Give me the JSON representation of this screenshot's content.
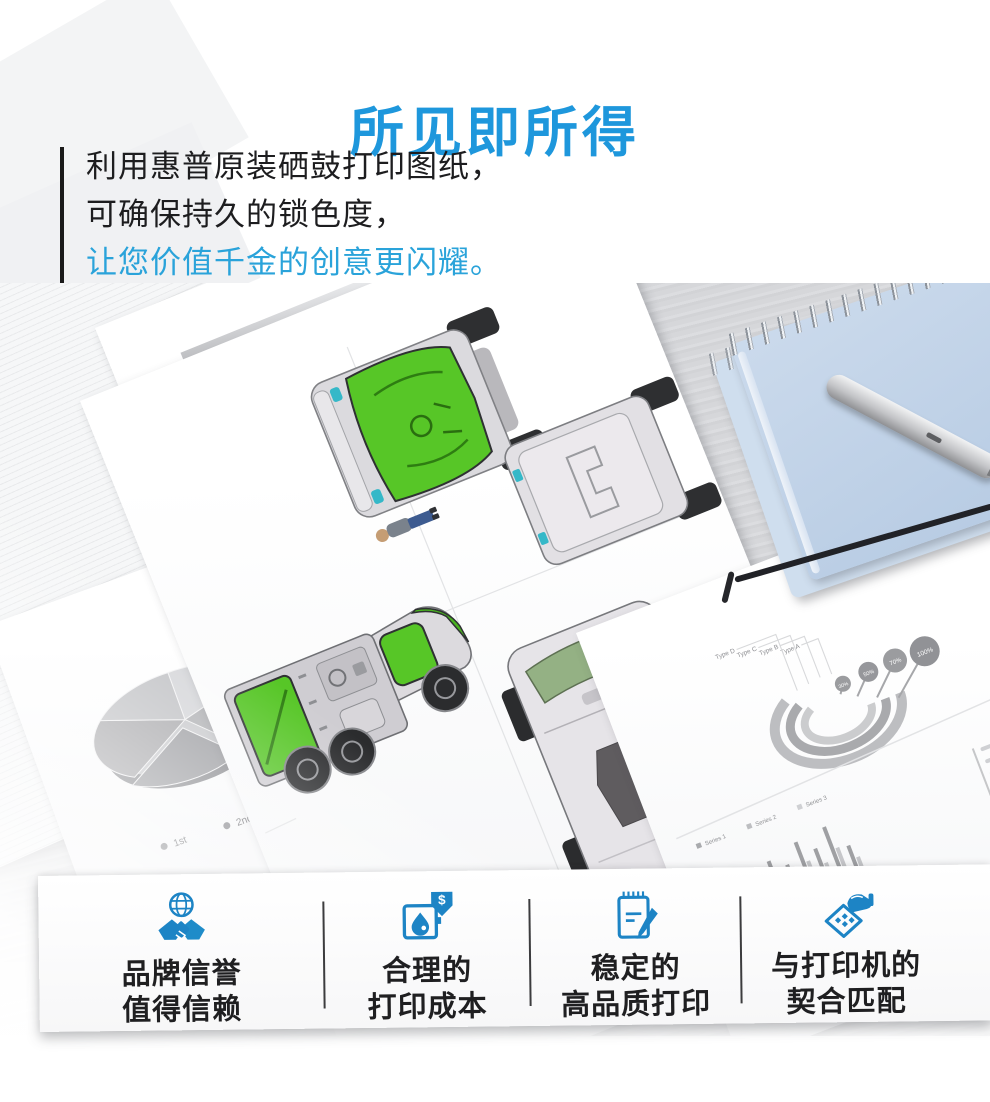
{
  "header": {
    "title": "所见即所得",
    "line1": "利用惠普原装硒鼓打印图纸，",
    "line2": "可确保持久的锁色度，",
    "line3": "让您价值千金的创意更闪耀。"
  },
  "colors": {
    "title_blue": "#1e97dc",
    "accent_blue": "#2aa3da",
    "icon_blue": "#1d84c5",
    "truck_green": "#57c627",
    "notebook_blue": "#bfd2e9",
    "desk_gray": "#d6d7da"
  },
  "photo": {
    "chart_paper": {
      "date1": "1/9/2002",
      "date2": "1/8/2002",
      "axis_ticks": [
        "3",
        "2",
        "1",
        "0"
      ]
    },
    "pie_paper": {
      "legend1": "1st",
      "legend2": "2nd"
    },
    "report_paper": {
      "type_labels": [
        "Type A",
        "Type B",
        "Type C",
        "Type D"
      ],
      "bubble_values": [
        "30%",
        "50%",
        "70%",
        "100%"
      ],
      "series_labels": [
        "Series 1",
        "Series 2",
        "Series 3"
      ]
    }
  },
  "features": {
    "items": [
      {
        "icon": "globe-handshake-icon",
        "line1": "品牌信誉",
        "line2": "值得信赖"
      },
      {
        "icon": "ink-drop-dollar-icon",
        "line1": "合理的",
        "line2": "打印成本"
      },
      {
        "icon": "notepad-pencil-icon",
        "line1": "稳定的",
        "line2": "高品质打印"
      },
      {
        "icon": "toner-hand-icon",
        "line1": "与打印机的",
        "line2": "契合匹配"
      }
    ]
  }
}
